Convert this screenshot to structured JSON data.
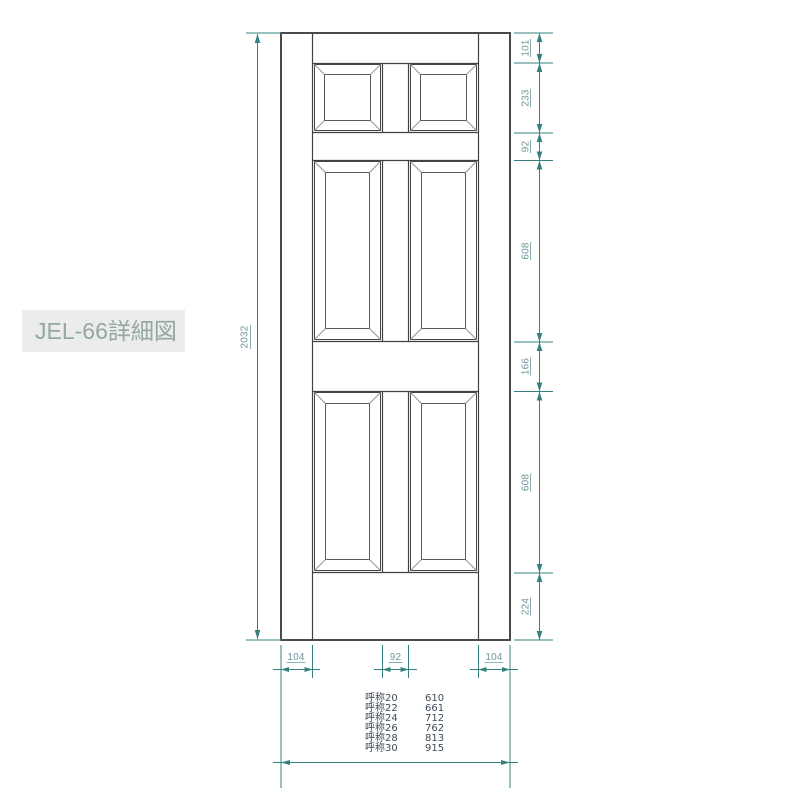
{
  "title_label": {
    "text": "JEL-66詳細図"
  },
  "drawing": {
    "total_height_label": "2032",
    "right_dimensions": [
      "101",
      "233",
      "92",
      "608",
      "166",
      "608",
      "224"
    ],
    "bottom_dimensions": [
      "104",
      "92",
      "104"
    ],
    "size_table": {
      "rows": [
        {
          "name": "呼称20",
          "value": "610"
        },
        {
          "name": "呼称22",
          "value": "661"
        },
        {
          "name": "呼称24",
          "value": "712"
        },
        {
          "name": "呼称26",
          "value": "762"
        },
        {
          "name": "呼称28",
          "value": "813"
        },
        {
          "name": "呼称30",
          "value": "915"
        }
      ]
    },
    "colors": {
      "dimension_line": "#35807f",
      "dimension_text": "#6f969a",
      "door_line": "#4a4a4a",
      "label_bg": "#ececec",
      "label_text": "#94a89d",
      "table_text": "#3d4a57"
    }
  }
}
